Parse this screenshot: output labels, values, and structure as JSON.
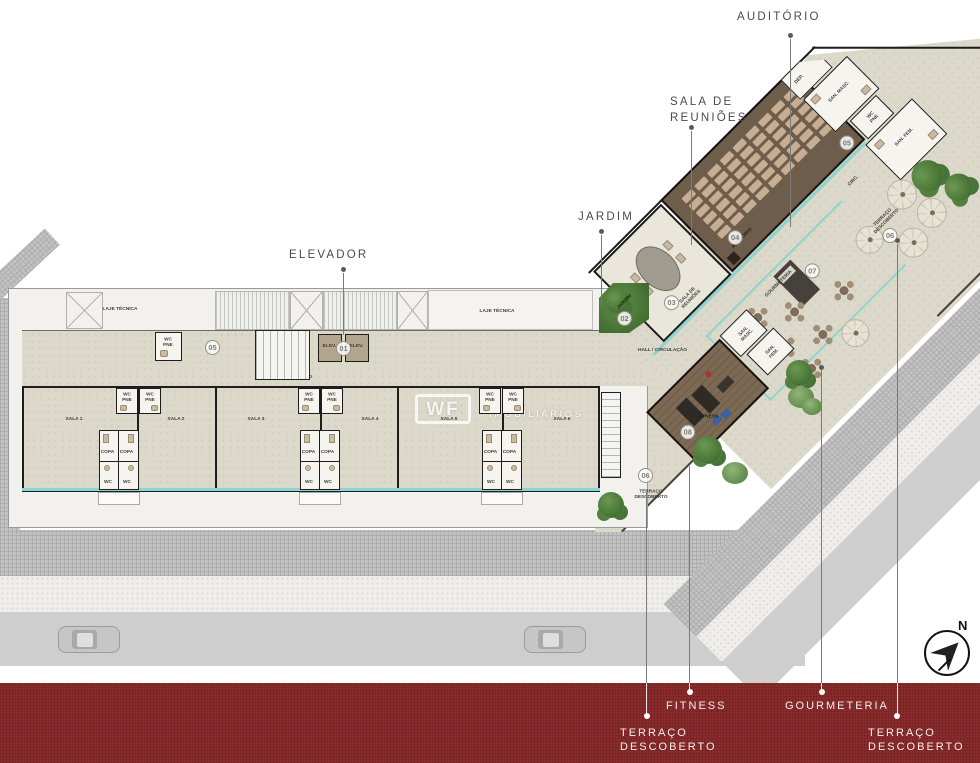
{
  "callouts": {
    "auditorio": "AUDITÓRIO",
    "sala_reunioes": [
      "SALA DE",
      "REUNIÕES"
    ],
    "jardim": "JARDIM",
    "elevador": "ELEVADOR",
    "fitness": "FITNESS",
    "gourmeteria": "GOURMETERIA",
    "terraco_left": [
      "TERRAÇO",
      "DESCOBERTO"
    ],
    "terraco_right": [
      "TERRAÇO",
      "DESCOBERTO"
    ]
  },
  "plan": {
    "laje_tecnica": "LAJE TÉCNICA",
    "hall": "HALL / CIRCULAÇÃO",
    "salas": [
      "SALA 1",
      "SALA 2",
      "SALA 3",
      "SALA 4",
      "SALA 5",
      "SALA 6"
    ],
    "wc_pne": "WC PNE",
    "copa": "COPA",
    "wc": "WC",
    "elev": "ELEV.",
    "sala_reunioes_room": "SALA DE REUNIÕES",
    "auditorio_room": "AUDITÓRIO",
    "jardim_room": "JARDIM",
    "gourmeteria_room": "GOURMETERIA",
    "terraco_room": "TERRAÇO DESCOBERTO",
    "fitness_room": "FITNESS",
    "dep": "DEP.",
    "san_masc": "SAN. MASC.",
    "san_fem": "SAN. FEM.",
    "circ": "CIRC."
  },
  "badges": {
    "elevator": "01",
    "jardim": "02",
    "meeting_room": "03",
    "auditorium": "04",
    "restrooms_hall": "05",
    "restrooms_wing": "05",
    "terrace_upper": "06",
    "terrace_lower": "06",
    "gourmeteria": "07",
    "fitness": "08"
  },
  "watermark": {
    "logo": "WF",
    "partial": "IOS",
    "line2": "IMOBILIÁRIOS"
  },
  "compass": {
    "north": "N"
  },
  "auditorium": {
    "seats": {
      "rows": 6,
      "cols": 9
    }
  },
  "colors": {
    "accent_teal": "#8BD5CF",
    "red_band": "#8C2B2C",
    "floor_beige": "#DCD8CA",
    "auditorium_wood": "#6F5D4B",
    "fitness_wood": "#7C6A55",
    "wall": "#1D1D1D"
  }
}
